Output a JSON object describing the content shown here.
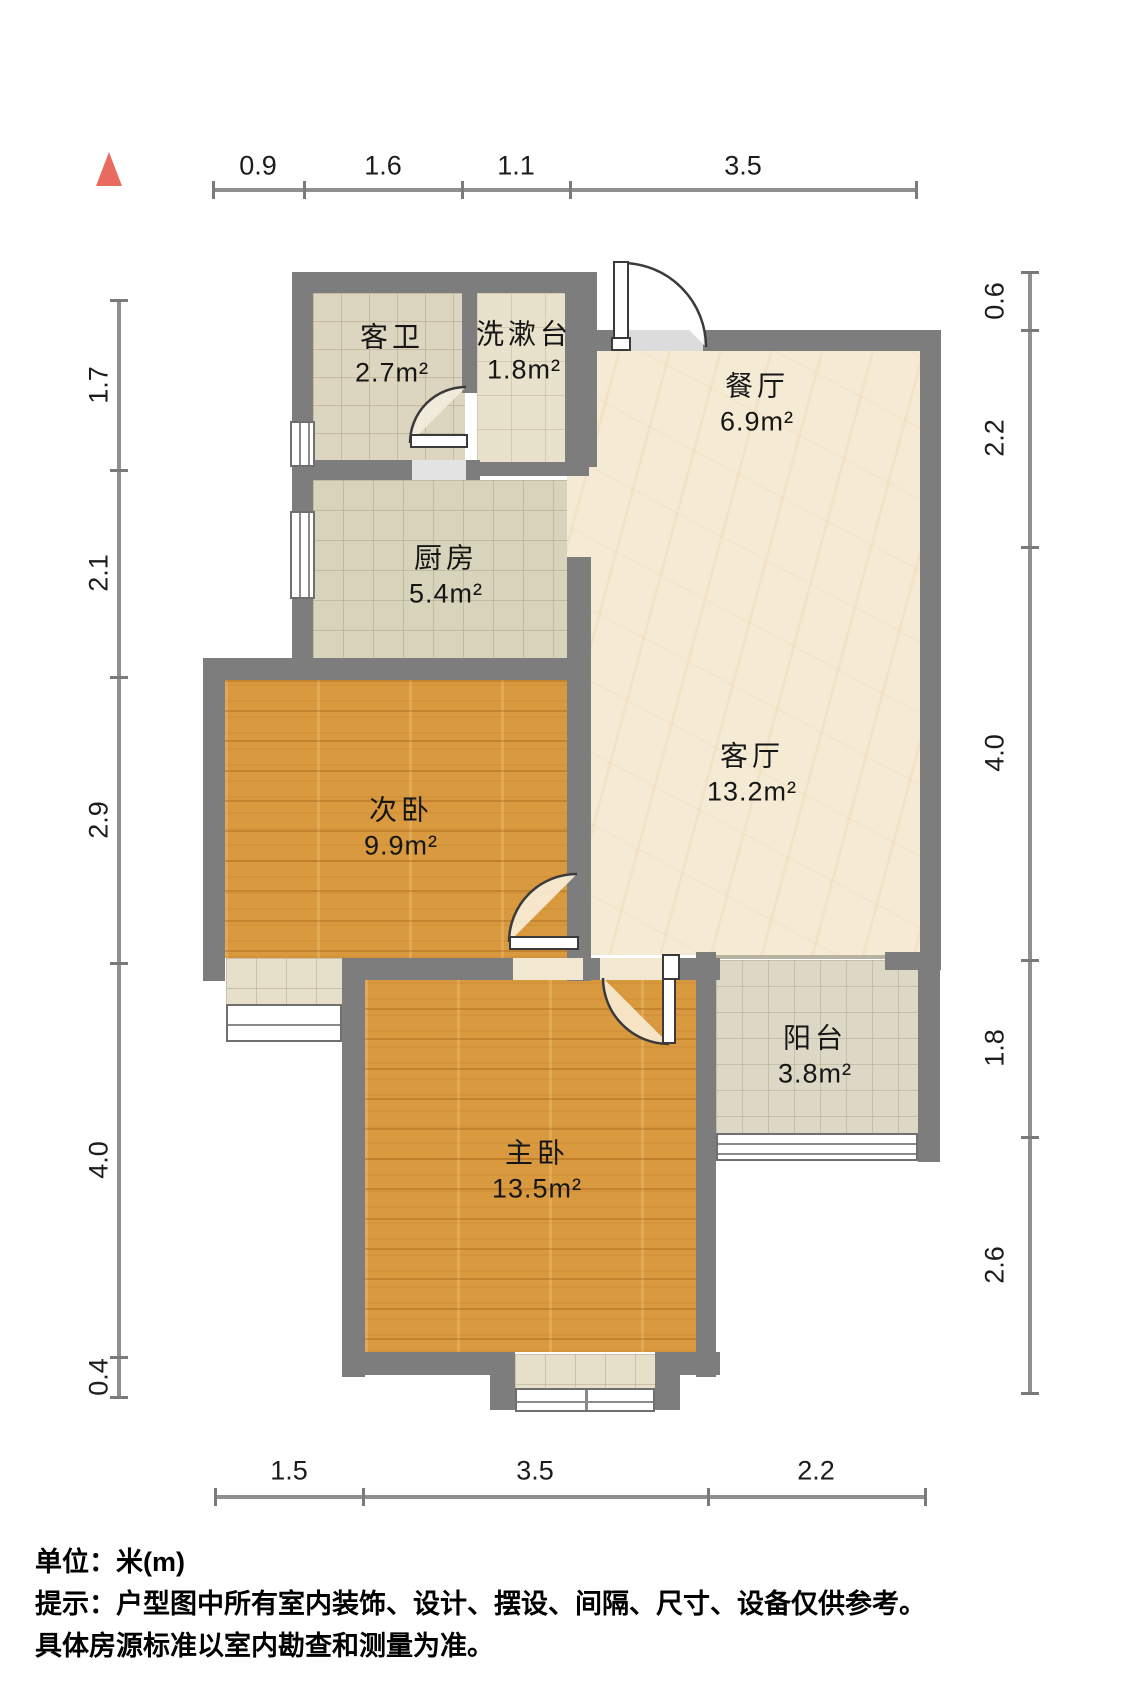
{
  "footer": {
    "unit_label": "单位：米(m)",
    "note_line1": "提示：户型图中所有室内装饰、设计、摆设、间隔、尺寸、设备仅供参考。",
    "note_line2": "具体房源标准以室内勘查和测量为准。"
  },
  "north_indicator": {
    "color": "#e96a5f",
    "x": 96,
    "y": 152,
    "w": 26,
    "h": 34
  },
  "colors": {
    "wall": "#7d7d7d",
    "dim_line": "#8f8f8f",
    "text": "#161616",
    "wood": "#d9993f",
    "marble": "#f5ebd5",
    "opening_fill": "#dcdcdc"
  },
  "rooms": [
    {
      "id": "guest-bath",
      "name": "客卫",
      "area": "2.7m²",
      "floor": "floor-tile-a",
      "rect": [
        313,
        293,
        152,
        167
      ],
      "label": [
        392,
        355
      ]
    },
    {
      "id": "washstand",
      "name": "洗漱台",
      "area": "1.8m²",
      "floor": "floor-tile-b",
      "rect": [
        477,
        293,
        88,
        172
      ],
      "label": [
        524,
        352
      ]
    },
    {
      "id": "dining",
      "name": "餐厅",
      "area": "6.9m²",
      "floor": "floor-marble",
      "rect": [
        567,
        351,
        353,
        604
      ],
      "label": [
        757,
        404
      ]
    },
    {
      "id": "kitchen",
      "name": "厨房",
      "area": "5.4m²",
      "floor": "floor-tile-k",
      "rect": [
        313,
        480,
        254,
        178
      ],
      "label": [
        446,
        576
      ]
    },
    {
      "id": "living",
      "name": "客厅",
      "area": "13.2m²",
      "floor": "",
      "rect": [
        0,
        0,
        0,
        0
      ],
      "label": [
        752,
        774
      ]
    },
    {
      "id": "second-bedroom",
      "name": "次卧",
      "area": "9.9m²",
      "floor": "floor-wood",
      "rect": [
        225,
        680,
        342,
        278
      ],
      "label": [
        401,
        828
      ]
    },
    {
      "id": "master-bedroom",
      "name": "主卧",
      "area": "13.5m²",
      "floor": "floor-wood",
      "rect": [
        365,
        978,
        333,
        374
      ],
      "label": [
        537,
        1171
      ]
    },
    {
      "id": "balcony",
      "name": "阳台",
      "area": "3.8m²",
      "floor": "floor-tile-bal",
      "rect": [
        716,
        960,
        202,
        175
      ],
      "label": [
        815,
        1056
      ]
    }
  ],
  "walls": [
    [
      292,
      272,
      21,
      401
    ],
    [
      292,
      272,
      305,
      21
    ],
    [
      462,
      293,
      15,
      100
    ],
    [
      313,
      460,
      99,
      20
    ],
    [
      466,
      460,
      14,
      20
    ],
    [
      477,
      462,
      112,
      14
    ],
    [
      565,
      272,
      32,
      195
    ],
    [
      565,
      330,
      52,
      21
    ],
    [
      703,
      330,
      238,
      21
    ],
    [
      920,
      330,
      21,
      640
    ],
    [
      885,
      952,
      33,
      18
    ],
    [
      567,
      557,
      24,
      424
    ],
    [
      203,
      658,
      388,
      22
    ],
    [
      203,
      658,
      22,
      323
    ],
    [
      348,
      958,
      165,
      22
    ],
    [
      583,
      958,
      17,
      22
    ],
    [
      666,
      958,
      54,
      22
    ],
    [
      342,
      958,
      23,
      419
    ],
    [
      696,
      952,
      20,
      425
    ],
    [
      342,
      1352,
      148,
      23
    ],
    [
      680,
      1352,
      40,
      23
    ],
    [
      490,
      1352,
      25,
      58
    ],
    [
      655,
      1352,
      25,
      58
    ],
    [
      918,
      952,
      22,
      210
    ]
  ],
  "thin_edges": [
    [
      716,
      955,
      169,
      4
    ]
  ],
  "openings": [
    {
      "id": "entry-opening",
      "rect": [
        617,
        330,
        86,
        21
      ],
      "fill": "#dcdcdc"
    },
    {
      "id": "bath-opening",
      "rect": [
        412,
        460,
        54,
        20
      ],
      "fill": "#e3e3e3"
    },
    {
      "id": "second-bedroom-opening",
      "rect": [
        513,
        958,
        70,
        22
      ],
      "fill": "#f2e8d2"
    },
    {
      "id": "master-opening",
      "rect": [
        600,
        958,
        66,
        22
      ],
      "fill": "#f2e8d2"
    }
  ],
  "doors": [
    {
      "id": "entry-door",
      "leaf": [
        613,
        261,
        16,
        88
      ],
      "foot": [
        611,
        337,
        20,
        14
      ],
      "arc": "M 622,263 A 84,84 0 0 1 706,347",
      "wedge": "#ffffff"
    },
    {
      "id": "guest-bath-door",
      "leaf": [
        410,
        434,
        58,
        14
      ],
      "foot": null,
      "arc": "M 410,443 A 56,56 0 0 1 466,387",
      "wedge": "#f2eddd"
    },
    {
      "id": "second-bedroom-door",
      "leaf": [
        509,
        936,
        70,
        14
      ],
      "foot": null,
      "arc": "M 509,942 A 68,68 0 0 1 577,874",
      "wedge": "#f8eedb"
    },
    {
      "id": "master-door",
      "leaf": [
        662,
        978,
        14,
        66
      ],
      "foot": [
        662,
        954,
        18,
        26
      ],
      "arc": "M 603,978 A 66,66 0 0 0 669,1044",
      "wedge": "#f8ecd4"
    }
  ],
  "windows": [
    {
      "id": "bath-window",
      "rect": [
        290,
        421,
        25,
        46
      ],
      "dir": "v",
      "panes": 3
    },
    {
      "id": "kitchen-window",
      "rect": [
        290,
        511,
        25,
        88
      ],
      "dir": "v",
      "panes": 3
    },
    {
      "id": "second-bedroom-bay-window",
      "rect": [
        226,
        1004,
        116,
        38
      ],
      "dir": "h",
      "panes": 2
    },
    {
      "id": "master-bay-window",
      "rect": [
        515,
        1388,
        140,
        24
      ],
      "dir": "h",
      "panes": 2,
      "mid_divider": true
    },
    {
      "id": "balcony-window",
      "rect": [
        716,
        1133,
        202,
        28
      ],
      "dir": "h",
      "panes": 3
    }
  ],
  "sills": [
    {
      "id": "second-bedroom-bay-sill",
      "rect": [
        226,
        958,
        116,
        48
      ]
    },
    {
      "id": "master-bay-sill",
      "rect": [
        515,
        1354,
        140,
        36
      ]
    }
  ],
  "dimensions": {
    "top": {
      "orient": "h",
      "pos": 190,
      "start": 213,
      "end": 916,
      "ticks": [
        213,
        304,
        462,
        570,
        916
      ],
      "labels": [
        {
          "t": "0.9",
          "c": 258
        },
        {
          "t": "1.6",
          "c": 383
        },
        {
          "t": "1.1",
          "c": 516
        },
        {
          "t": "3.5",
          "c": 743
        }
      ],
      "label_off": 166
    },
    "bottom": {
      "orient": "h",
      "pos": 1497,
      "start": 215,
      "end": 925,
      "ticks": [
        215,
        363,
        708,
        925
      ],
      "labels": [
        {
          "t": "1.5",
          "c": 289
        },
        {
          "t": "3.5",
          "c": 535
        },
        {
          "t": "2.2",
          "c": 816
        }
      ],
      "label_off": 1471
    },
    "left": {
      "orient": "v",
      "pos": 119,
      "start": 300,
      "end": 1397,
      "ticks": [
        300,
        470,
        677,
        963,
        1357,
        1397
      ],
      "labels": [
        {
          "t": "1.7",
          "c": 385
        },
        {
          "t": "2.1",
          "c": 573
        },
        {
          "t": "2.9",
          "c": 820
        },
        {
          "t": "4.0",
          "c": 1160
        },
        {
          "t": "0.4",
          "c": 1377
        }
      ],
      "label_off": 99
    },
    "right": {
      "orient": "v",
      "pos": 1030,
      "start": 272,
      "end": 1393,
      "ticks": [
        272,
        330,
        547,
        960,
        1137,
        1393
      ],
      "labels": [
        {
          "t": "0.6",
          "c": 301
        },
        {
          "t": "2.2",
          "c": 438
        },
        {
          "t": "4.0",
          "c": 753
        },
        {
          "t": "1.8",
          "c": 1048
        },
        {
          "t": "2.6",
          "c": 1265
        }
      ],
      "label_off": 995
    }
  }
}
